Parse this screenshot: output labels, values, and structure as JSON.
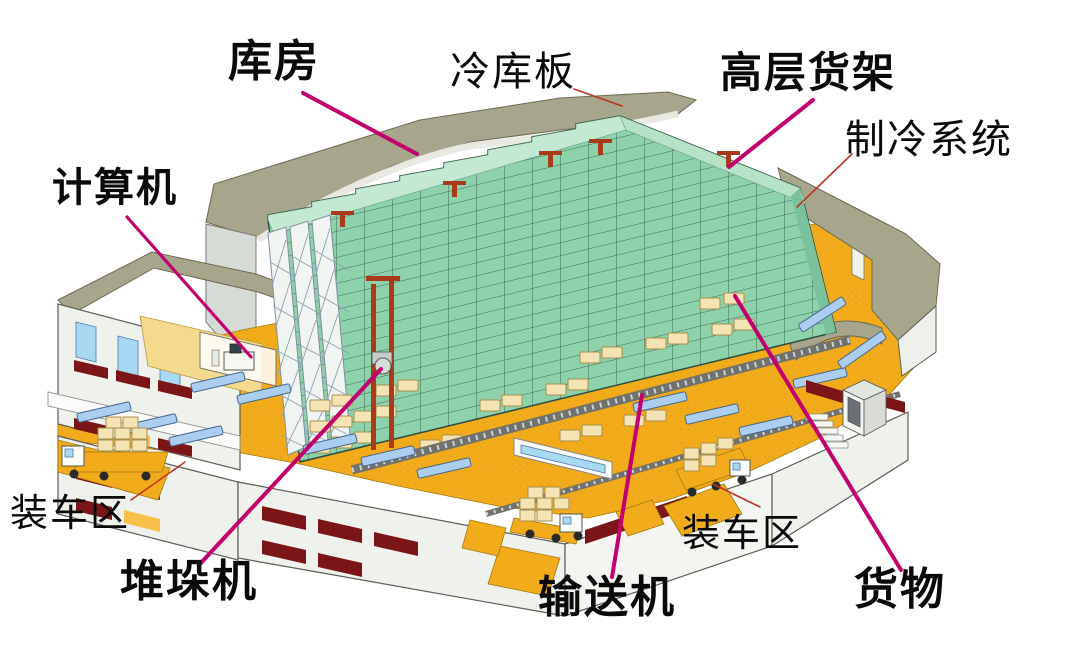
{
  "diagram": {
    "type": "warehouse-cutaway-illustration",
    "labels": {
      "kufang": "库房",
      "lengkuban": "冷库板",
      "gaocenghuojia": "高层货架",
      "zhilengxitong": "制冷系统",
      "jisuanji": "计算机",
      "zhuangchequ_left": "装车区",
      "duiduoji": "堆垛机",
      "shusongji": "输送机",
      "zhuangchequ_right": "装车区",
      "huowu": "货物"
    },
    "colors": {
      "leader_primary": "#c2006e",
      "leader_secondary": "#c03424",
      "rack_green": "#8ed2ab",
      "rack_top_green": "#c4e9d3",
      "floor_orange": "#f2ab1b",
      "roof_olive": "#a7a58c",
      "conveyor_blue": "#aacdf0",
      "pallet_cream": "#f4e4b4",
      "mast_red": "#aa3a1c",
      "window_red": "#7c1517",
      "label_text": "#0a0a0a",
      "background": "#ffffff"
    }
  }
}
